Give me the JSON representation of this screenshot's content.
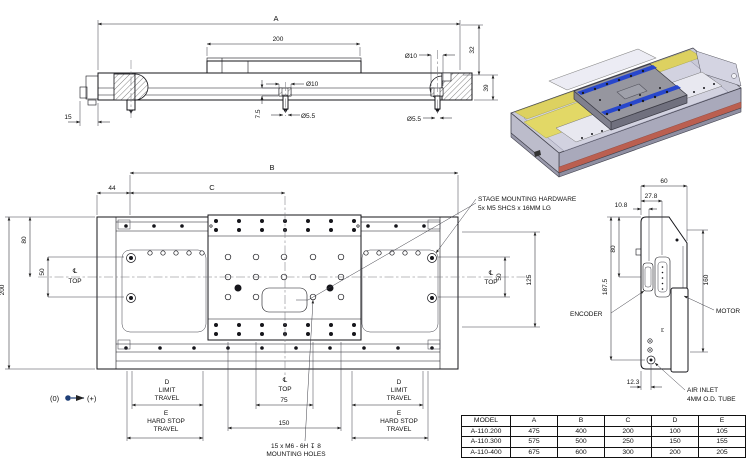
{
  "side_view": {
    "dim_a": "A",
    "dim_200": "200",
    "dim_dia10": "Ø10",
    "dim_dia55": "Ø5.5",
    "dim_15": "15",
    "dim_7_5": "7.5",
    "dim_32": "32",
    "dim_39": "39"
  },
  "top_view": {
    "dim_b": "B",
    "dim_c": "C",
    "dim_44": "44",
    "dim_200": "200",
    "dim_80": "80",
    "dim_50": "50",
    "dim_125": "125",
    "dim_75": "75",
    "dim_150": "150",
    "centerline_symbol": "℄",
    "top_label": "TOP",
    "travel_d": "D",
    "travel_limit": "LIMIT",
    "travel_travel": "TRAVEL",
    "travel_e": "E",
    "travel_hard_stop": "HARD STOP",
    "callout_hw_1": "STAGE MOUNTING HARDWARE",
    "callout_hw_2": "5x M5 SHCS x 16MM LG",
    "callout_holes_1": "15 x M6 - 6H ↧ 8",
    "callout_holes_2": "MOUNTING HOLES",
    "origin_zero": "(0)",
    "origin_plus": "(+)"
  },
  "end_view": {
    "dim_60": "60",
    "dim_27_8": "27.8",
    "dim_10_8": "10.8",
    "dim_80": "80",
    "dim_187_5": "187.5",
    "dim_160": "160",
    "dim_12_3": "12.3",
    "encoder": "ENCODER",
    "motor": "MOTOR",
    "air_inlet_1": "AIR INLET",
    "air_inlet_2": "4MM O.D. TUBE"
  },
  "table": {
    "headers": [
      "MODEL",
      "A",
      "B",
      "C",
      "D",
      "E"
    ],
    "rows": [
      [
        "A-110.200",
        "475",
        "400",
        "200",
        "100",
        "105"
      ],
      [
        "A-110.300",
        "575",
        "500",
        "250",
        "150",
        "155"
      ],
      [
        "A-110-400",
        "675",
        "600",
        "300",
        "200",
        "205"
      ]
    ]
  },
  "colors": {
    "accent_blue_rail": "#2847cc",
    "accent_yellow": "#ddd160",
    "accent_red": "#bb5f50",
    "origin_dot": "#1f3f77"
  }
}
